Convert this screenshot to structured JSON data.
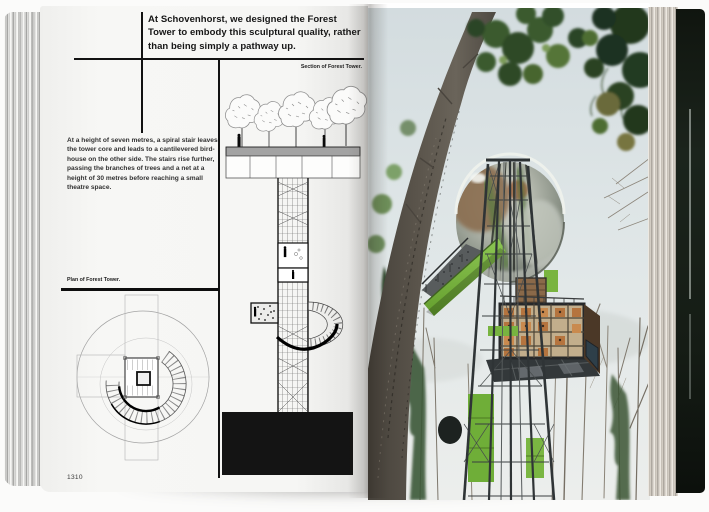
{
  "left_page": {
    "intro_text": "At Schovenhorst, we designed the Forest Tower to embody this sculptural quality, rather than being simply a pathway up.",
    "section_caption": "Section of Forest Tower.",
    "body_text": "At a height of seven metres, a spiral stair leaves the tower core and leads to a cantilevered bird-house on the other side. The stairs rise further, passing the branches of trees and a net at a height of 30 metres before reaching a small theatre space.",
    "plan_caption": "Plan of Forest Tower.",
    "page_number": "1310"
  },
  "right_page": {
    "photo_alt": "View up the Forest Tower: steel lattice with bright green accents, a cantilevered birdhouse box and a mirrored sphere rising into tall trees"
  },
  "colors": {
    "accent_green": "#7cb342",
    "sky": "#dde4e6",
    "cover_dark": "#141b15",
    "paper": "#f6f6f4",
    "ink": "#121212"
  }
}
